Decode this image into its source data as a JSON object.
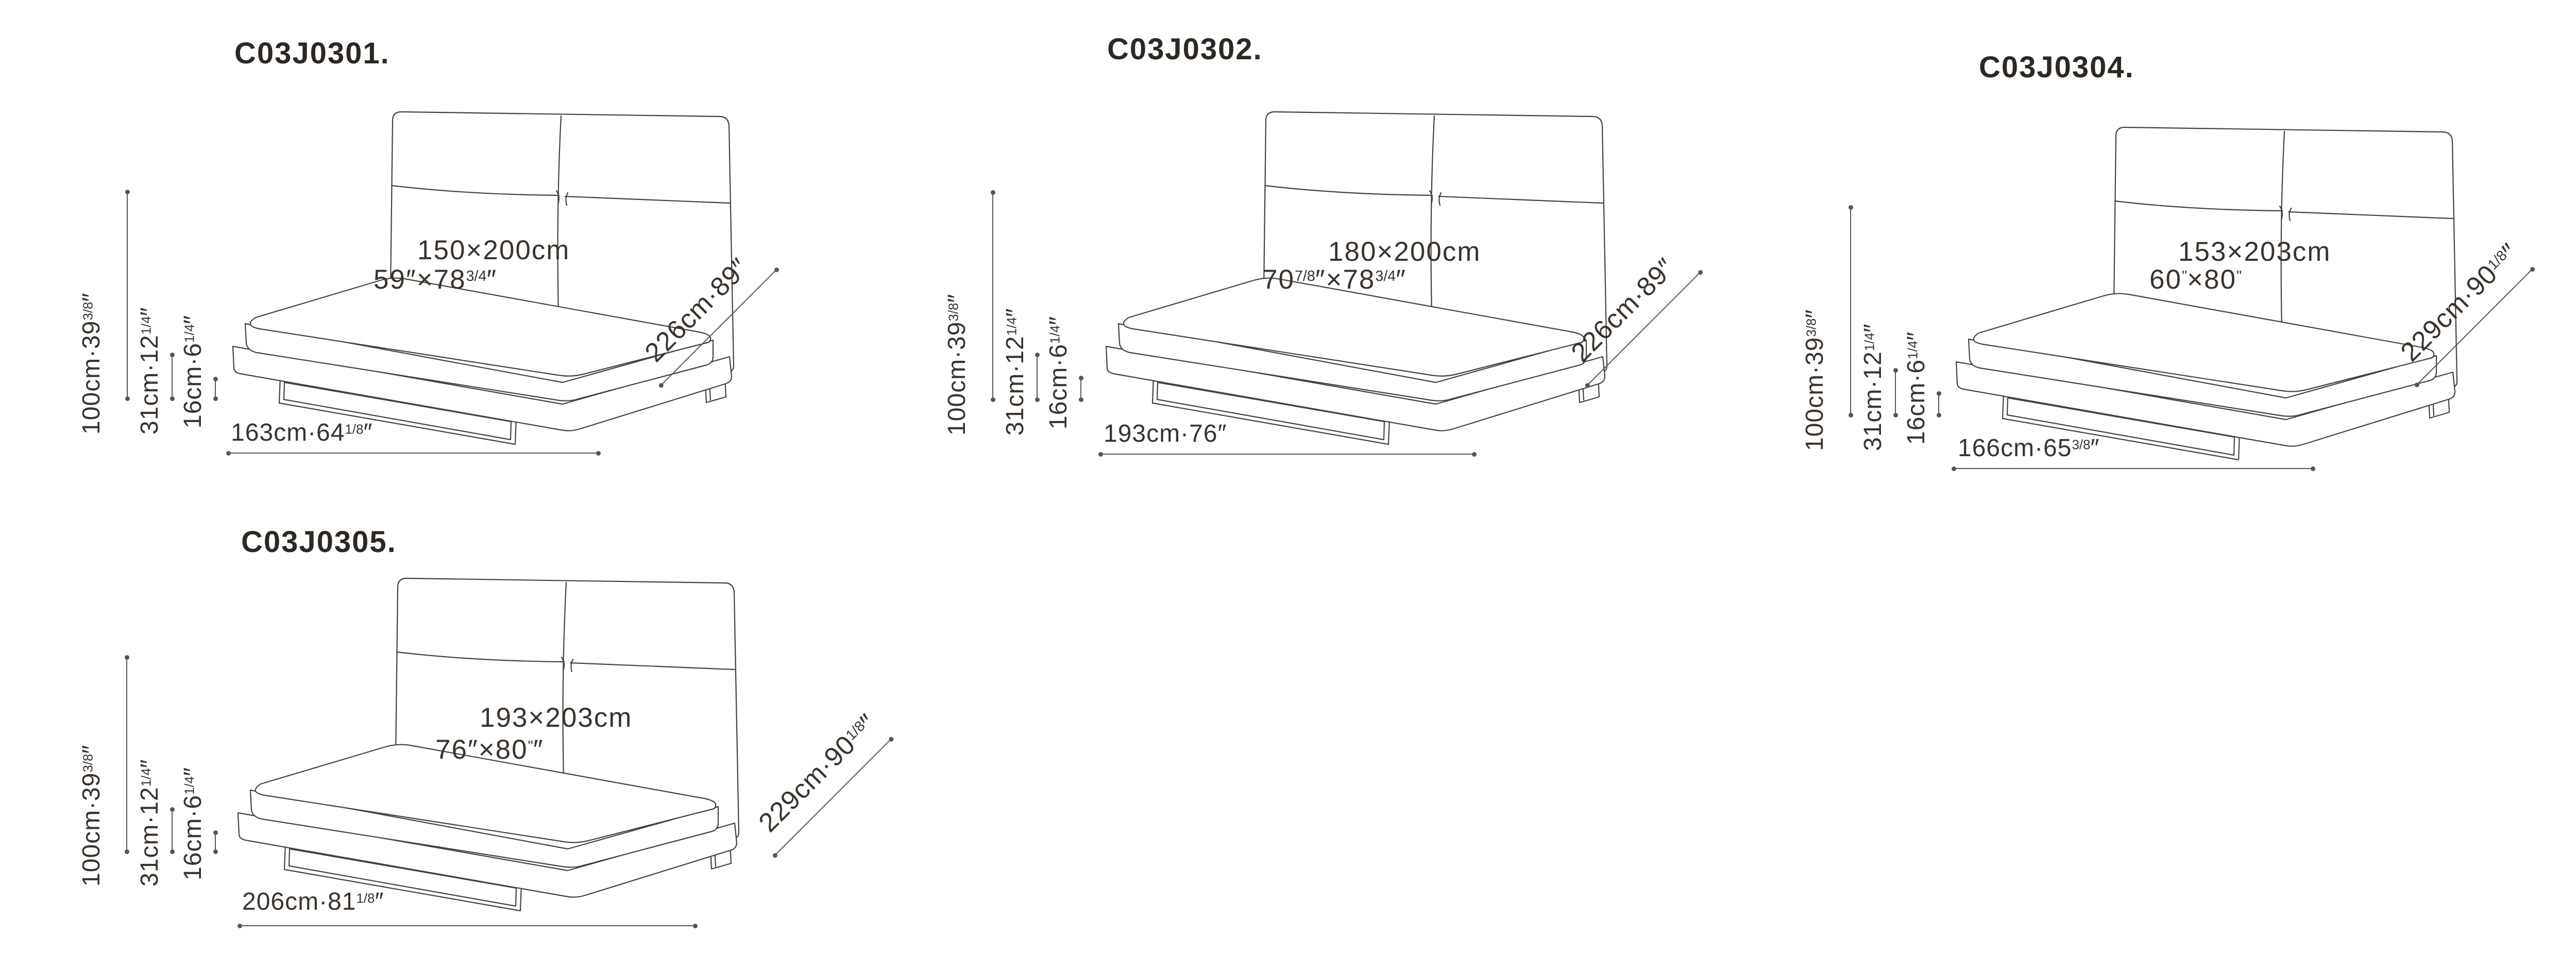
{
  "page": {
    "background": "#ffffff",
    "line_color": "#5b544e",
    "art_line_color": "#46403a",
    "text_color": "#3a332d"
  },
  "beds": [
    {
      "model": "C03J0301.",
      "mattress": {
        "line1": "150×200cm",
        "line2": [
          {
            "t": "59″×78"
          },
          {
            "t": "3/4",
            "sup": true
          },
          {
            "t": "″"
          }
        ]
      },
      "dims": {
        "height": [
          {
            "t": "100cm·39"
          },
          {
            "t": "3/8",
            "sup": true
          },
          {
            "t": "″"
          }
        ],
        "frame_height": [
          {
            "t": "31cm·12"
          },
          {
            "t": "1/4",
            "sup": true
          },
          {
            "t": "″"
          }
        ],
        "base_height": [
          {
            "t": "16cm·6"
          },
          {
            "t": "1/4",
            "sup": true
          },
          {
            "t": "″"
          }
        ],
        "width": [
          {
            "t": "163cm·64"
          },
          {
            "t": "1/8",
            "sup": true
          },
          {
            "t": "″"
          }
        ],
        "depth": [
          {
            "t": "226cm·89″"
          }
        ]
      }
    },
    {
      "model": "C03J0302.",
      "mattress": {
        "line1": "180×200cm",
        "line2": [
          {
            "t": "70"
          },
          {
            "t": "7/8",
            "sup": true
          },
          {
            "t": "″×78"
          },
          {
            "t": "3/4",
            "sup": true
          },
          {
            "t": "″"
          }
        ]
      },
      "dims": {
        "height": [
          {
            "t": "100cm·39"
          },
          {
            "t": "3/8",
            "sup": true
          },
          {
            "t": "″"
          }
        ],
        "frame_height": [
          {
            "t": "31cm·12"
          },
          {
            "t": "1/4",
            "sup": true
          },
          {
            "t": "″"
          }
        ],
        "base_height": [
          {
            "t": "16cm·6"
          },
          {
            "t": "1/4",
            "sup": true
          },
          {
            "t": "″"
          }
        ],
        "width": [
          {
            "t": "193cm·76″"
          }
        ],
        "depth": [
          {
            "t": "226cm·89″"
          }
        ]
      }
    },
    {
      "model": "C03J0304.",
      "mattress": {
        "line1": "153×203cm",
        "line2": [
          {
            "t": "60"
          },
          {
            "t": "\"",
            "sup": true
          },
          {
            "t": "×80"
          },
          {
            "t": "\"",
            "sup": true
          }
        ]
      },
      "dims": {
        "height": [
          {
            "t": "100cm·39"
          },
          {
            "t": "3/8",
            "sup": true
          },
          {
            "t": "″"
          }
        ],
        "frame_height": [
          {
            "t": "31cm·12"
          },
          {
            "t": "1/4",
            "sup": true
          },
          {
            "t": "″"
          }
        ],
        "base_height": [
          {
            "t": "16cm·6"
          },
          {
            "t": "1/4",
            "sup": true
          },
          {
            "t": "″"
          }
        ],
        "width": [
          {
            "t": "166cm·65"
          },
          {
            "t": "3/8",
            "sup": true
          },
          {
            "t": "″"
          }
        ],
        "depth": [
          {
            "t": "229cm·90"
          },
          {
            "t": "1/8",
            "sup": true
          },
          {
            "t": "″"
          }
        ]
      }
    },
    {
      "model": "C03J0305.",
      "mattress": {
        "line1": "193×203cm",
        "line2": [
          {
            "t": "76″×80"
          },
          {
            "t": "\"",
            "sup": true
          },
          {
            "t": "″"
          }
        ]
      },
      "dims": {
        "height": [
          {
            "t": "100cm·39"
          },
          {
            "t": "3/8",
            "sup": true
          },
          {
            "t": "″"
          }
        ],
        "frame_height": [
          {
            "t": "31cm·12"
          },
          {
            "t": "1/4",
            "sup": true
          },
          {
            "t": "″"
          }
        ],
        "base_height": [
          {
            "t": "16cm·6"
          },
          {
            "t": "1/4",
            "sup": true
          },
          {
            "t": "″"
          }
        ],
        "width": [
          {
            "t": "206cm·81"
          },
          {
            "t": "1/8",
            "sup": true
          },
          {
            "t": "″"
          }
        ],
        "depth": [
          {
            "t": "229cm·90"
          },
          {
            "t": "1/8",
            "sup": true
          },
          {
            "t": "″"
          }
        ]
      }
    }
  ]
}
